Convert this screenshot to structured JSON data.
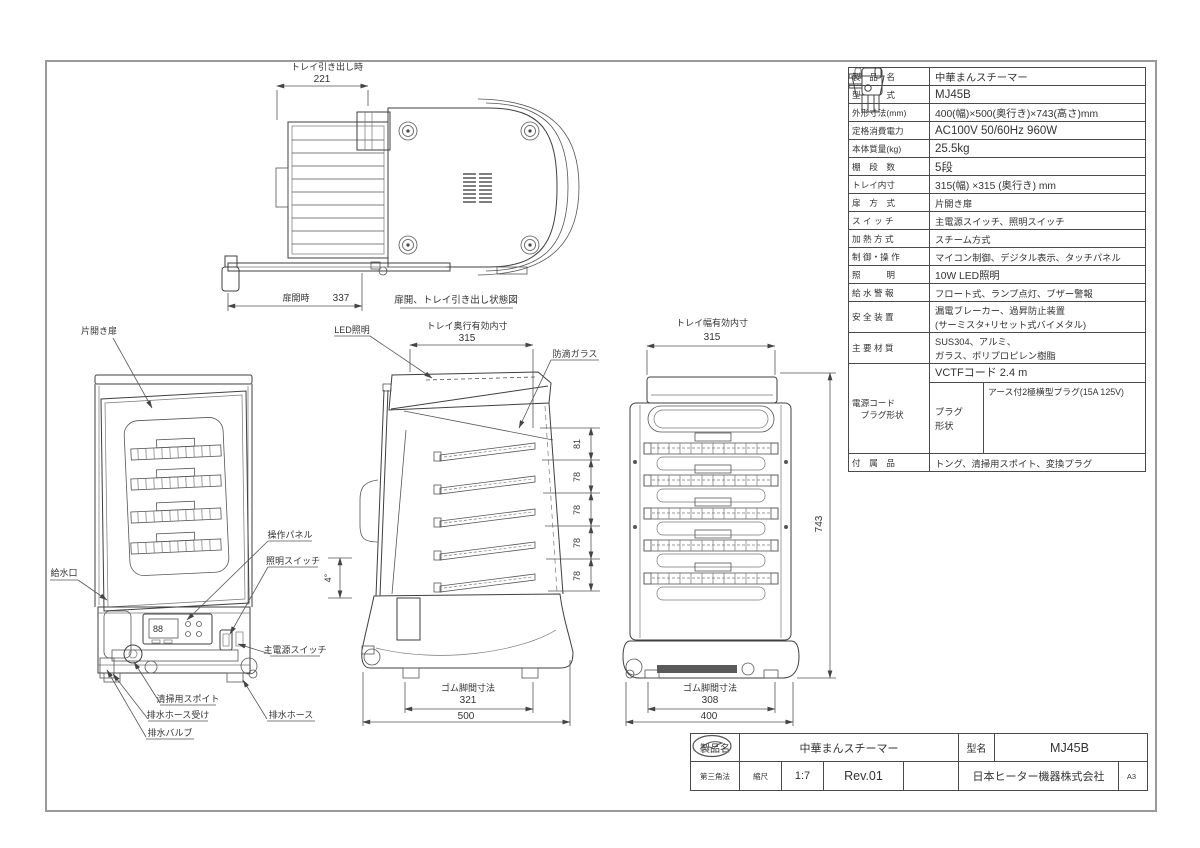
{
  "top_view": {
    "pullout_label": "トレイ引き出し時",
    "pullout_value": "221",
    "door_open_label": "扉開時",
    "door_open_value": "337",
    "caption": "扉開、トレイ引き出し状態図"
  },
  "front_view": {
    "door_label": "片開き扉",
    "water_inlet_label": "給水口",
    "operation_panel_label": "操作パネル",
    "light_switch_label": "照明スイッチ",
    "main_power_switch_label": "主電源スイッチ",
    "dropper_label": "清掃用スポイト",
    "drain_hose_holder_label": "排水ホース受け",
    "drain_valve_label": "排水バルブ",
    "drain_hose_label": "排水ホース"
  },
  "side_view": {
    "tray_depth_label": "トレイ奥行有効内寸",
    "tray_depth_value": "315",
    "led_label": "LED照明",
    "glass_label": "防滴ガラス",
    "pitch_values": [
      "81",
      "78",
      "78",
      "78",
      "78"
    ],
    "tilt_value": "4°",
    "feet_label": "ゴム脚間寸法",
    "feet_value": "321",
    "depth_value": "500"
  },
  "rear_view": {
    "tray_width_label": "トレイ幅有効内寸",
    "tray_width_value": "315",
    "height_value": "743",
    "feet_label": "ゴム脚間寸法",
    "feet_value": "308",
    "width_value": "400"
  },
  "spec_table": {
    "rows": [
      {
        "label": "製　品　名",
        "value": "中華まんスチーマー"
      },
      {
        "label": "型　　　式",
        "value": "MJ45B"
      },
      {
        "label": "外形寸法(mm)",
        "value": "400(幅)×500(奥行き)×743(高さ)mm"
      },
      {
        "label": "定格消費電力",
        "value": "AC100V 50/60Hz 960W"
      },
      {
        "label": "本体質量(kg)",
        "value": "25.5kg"
      },
      {
        "label": "棚　段　数",
        "value": "5段"
      },
      {
        "label": "トレイ内寸",
        "value": "315(幅) ×315 (奥行き) mm"
      },
      {
        "label": "扉　方　式",
        "value": "片開き扉"
      },
      {
        "label": "ス イ ッ チ",
        "value": "主電源スイッチ、照明スイッチ"
      },
      {
        "label": "加 熱 方 式",
        "value": "スチーム方式"
      },
      {
        "label": "制 御・操 作",
        "value": "マイコン制御、デジタル表示、タッチパネル"
      },
      {
        "label": "照　　　明",
        "value": "10W LED照明"
      },
      {
        "label": "給 水 警 報",
        "value": "フロート式、ランプ点灯、ブザー警報"
      },
      {
        "label": "安 全 装 置",
        "value": "漏電ブレーカー、過昇防止装置\n(サーミスタ+リセット式バイメタル)"
      },
      {
        "label": "主 要 材 質",
        "value": "SUS304、アルミ、\nガラス、ポリプロピレン樹脂"
      },
      {
        "label": "付　属　品",
        "value": "トング、清掃用スポイト、変換プラグ"
      }
    ],
    "power_cord": {
      "label": "電源コード\n　プラグ形状",
      "cord_value": "VCTFコード 2.4 m",
      "plug_shape_label": "プラグ\n形状",
      "plug_type": "アース付2極横型プラグ(15A 125V)"
    }
  },
  "title_block": {
    "product_label": "製品名",
    "product_value": "中華まんスチーマー",
    "model_label": "型名",
    "model_value": "MJ45B",
    "projection": "第三角法",
    "scale_label": "縮尺",
    "scale_value": "1:7",
    "revision": "Rev.01",
    "company": "日本ヒーター機器株式会社",
    "paper_size": "A3"
  }
}
